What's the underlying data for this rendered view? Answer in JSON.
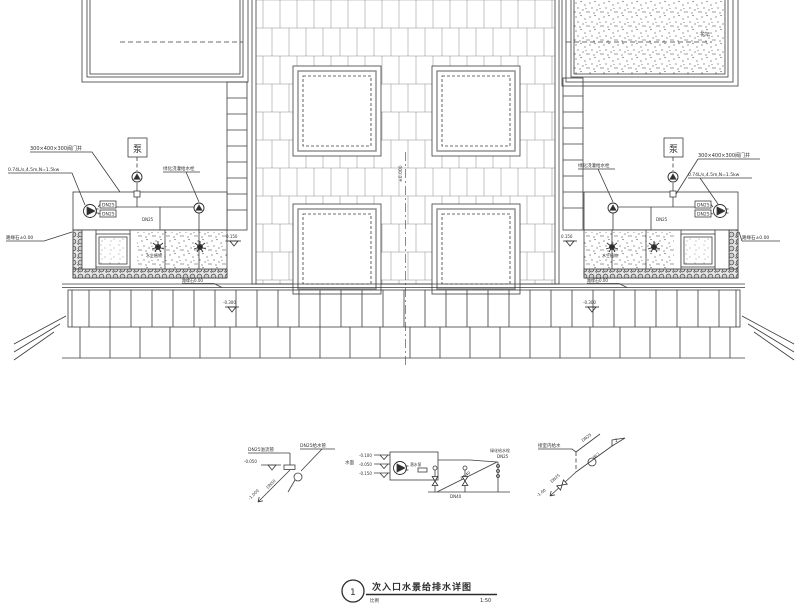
{
  "title_block": {
    "number": "1",
    "title": "次入口水景给排水详图",
    "scale_note": "比例",
    "scale": "1:50"
  },
  "plan": {
    "left": {
      "pit_label": "300×400×300阀门井",
      "pump_spec": "0.74L/s,4.5m,N=1.5kw",
      "irrigation_label": "绿化浇灌给水栓",
      "pump_box_glyph": "泵",
      "dn1": "DN25",
      "dn2": "DN25",
      "dn3": "DN25",
      "curb_label": "路缘石±0.00",
      "water_level": "0.150",
      "bed_label": "水生植物"
    },
    "center": {
      "axis_label": "±0.000",
      "planter_label": "花坛"
    },
    "bands": {
      "level": "-0.300",
      "curb": "路缘石0.00"
    }
  },
  "schematics": {
    "left": {
      "overflow_label": "DN25溢流管",
      "supply_label": "DN25给水管",
      "level_a": "-0.050",
      "pipe_dn": "DN50",
      "level_b": "-1.000"
    },
    "middle": {
      "surface_label": "水面",
      "levels": [
        "-0.100",
        "-0.050",
        "-0.150"
      ],
      "pump_label": "潜水泵",
      "dn_mid": "DN40",
      "dn_bottom": "DN40",
      "tap_label": "绿化给水栓",
      "tap_dn": "DN25"
    },
    "right": {
      "source_label": "接室内给水",
      "dn_up": "DN25",
      "dn_down": "DN25",
      "valve_label": "阀门",
      "level": "-1.00",
      "flag": "1"
    }
  },
  "colors": {
    "line": "#3c3c3c",
    "accent": "#2c2c2c"
  }
}
